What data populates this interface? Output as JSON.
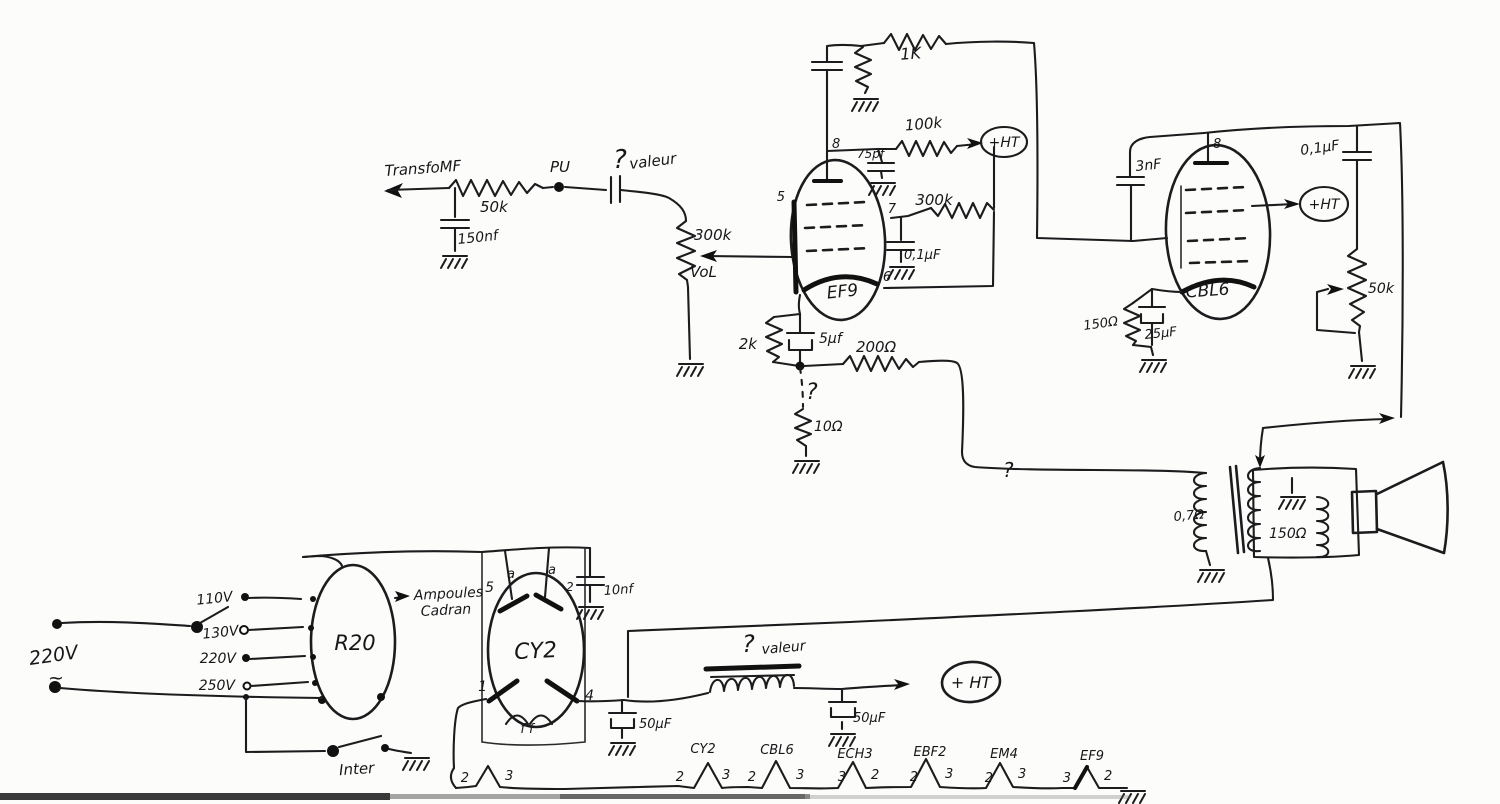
{
  "input": {
    "transfo": "TransfoMF",
    "series_resistor": "50k",
    "shunt_cap": "150nf",
    "pickup": "PU",
    "cap_question": "?",
    "cap_valeur": "valeur",
    "volume_resistance": "300k",
    "volume_label": "VoL"
  },
  "ef9": {
    "name": "EF9",
    "pin5": "5",
    "pin8": "8",
    "pin7": "7",
    "pin6": "6",
    "anode_resistor": "100k",
    "ht": "+HT",
    "screen_resistor": "300k",
    "screen_cap": "0,1μF",
    "anode_cap": "75pf",
    "coupling_resistor": "1K",
    "cathode_resistor": "2k",
    "cathode_cap": "5μf",
    "backbias_resistor": "200Ω",
    "question": "?",
    "hum_resistor": "10Ω"
  },
  "cbl6": {
    "name": "CBL6",
    "pin8": "8",
    "grid_cap": "3nF",
    "ht": "+HT",
    "tone_cap": "0,1μF",
    "tone_pot": "50k",
    "cathode_resistor": "150Ω",
    "cathode_cap": "25μF"
  },
  "output": {
    "primary": "0,7Ω",
    "secondary": "150Ω",
    "question": "?"
  },
  "power": {
    "mains": "220V",
    "mains_wave": "~",
    "tap110": "110V",
    "tap130": "130V",
    "tap220": "220V",
    "tap250": "250V",
    "transfo": "R20",
    "lamps1": "Ampoules",
    "lamps2": "Cadran",
    "rectifier": "CY2",
    "a_left": "a",
    "a_right": "a",
    "pin5": "5",
    "pin2": "2",
    "pin1": "1",
    "pin4": "4",
    "filament": "f f",
    "anode_cap": "10nf",
    "switch": "Inter",
    "cap1": "50μF",
    "choke_question": "?",
    "choke_valeur": "valeur",
    "cap2": "50μF",
    "ht": "+ HT"
  },
  "heaters": {
    "pre_left": "2",
    "pre_right": "3",
    "tubes": [
      {
        "name": "CY2",
        "left": "2",
        "right": "3"
      },
      {
        "name": "CBL6",
        "left": "2",
        "right": "3"
      },
      {
        "name": "ECH3",
        "left": "3",
        "right": "2"
      },
      {
        "name": "EBF2",
        "left": "2",
        "right": "3"
      },
      {
        "name": "EM4",
        "left": "2",
        "right": "3"
      },
      {
        "name": "EF9",
        "left": "3",
        "right": "2"
      }
    ]
  }
}
